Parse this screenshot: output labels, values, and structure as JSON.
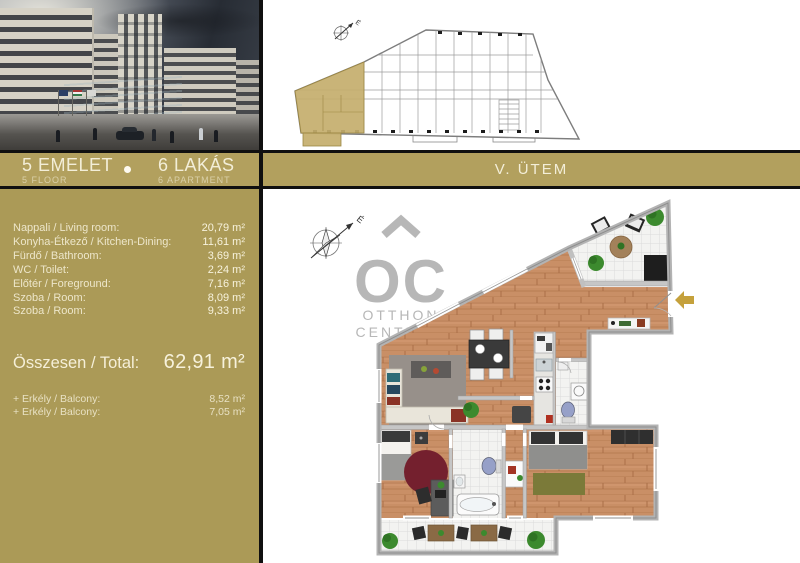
{
  "header": {
    "floor": {
      "title": "5 EMELET",
      "subtitle": "5 FLOOR"
    },
    "apartments": {
      "title": "6 LAKÁS",
      "subtitle": "6 APARTMENT"
    },
    "phase": "V. ÜTEM"
  },
  "summary": {
    "rooms": [
      {
        "label": "Nappali / Living room:",
        "area": "20,79 m²"
      },
      {
        "label": "Konyha-Étkező / Kitchen-Dining:",
        "area": "11,61 m²"
      },
      {
        "label": "Fürdő / Bathroom:",
        "area": "3,69 m²"
      },
      {
        "label": "WC / Toilet:",
        "area": "2,24 m²"
      },
      {
        "label": "Előtér / Foreground:",
        "area": "7,16 m²"
      },
      {
        "label": "Szoba / Room:",
        "area": "8,09 m²"
      },
      {
        "label": "Szoba / Room:",
        "area": "9,33 m²"
      }
    ],
    "total": {
      "label": "Összesen / Total:",
      "area": "62,91 m²"
    },
    "extras": [
      {
        "label": "+ Erkély / Balcony:",
        "area": "8,52 m²"
      },
      {
        "label": "+ Erkély / Balcony:",
        "area": "7,05 m²"
      }
    ]
  },
  "logo": {
    "mark": "OC",
    "line1": "OTTHON",
    "line2": "CENTRUM"
  },
  "compass": {
    "north_label": "É"
  },
  "site_plan": {
    "compass_label": "É"
  },
  "colors": {
    "gold_panel": "#ab9a57",
    "gold_band": "#b2a05e",
    "entrance_arrow": "#c5a13c",
    "cream_text": "#f1ebd3"
  }
}
